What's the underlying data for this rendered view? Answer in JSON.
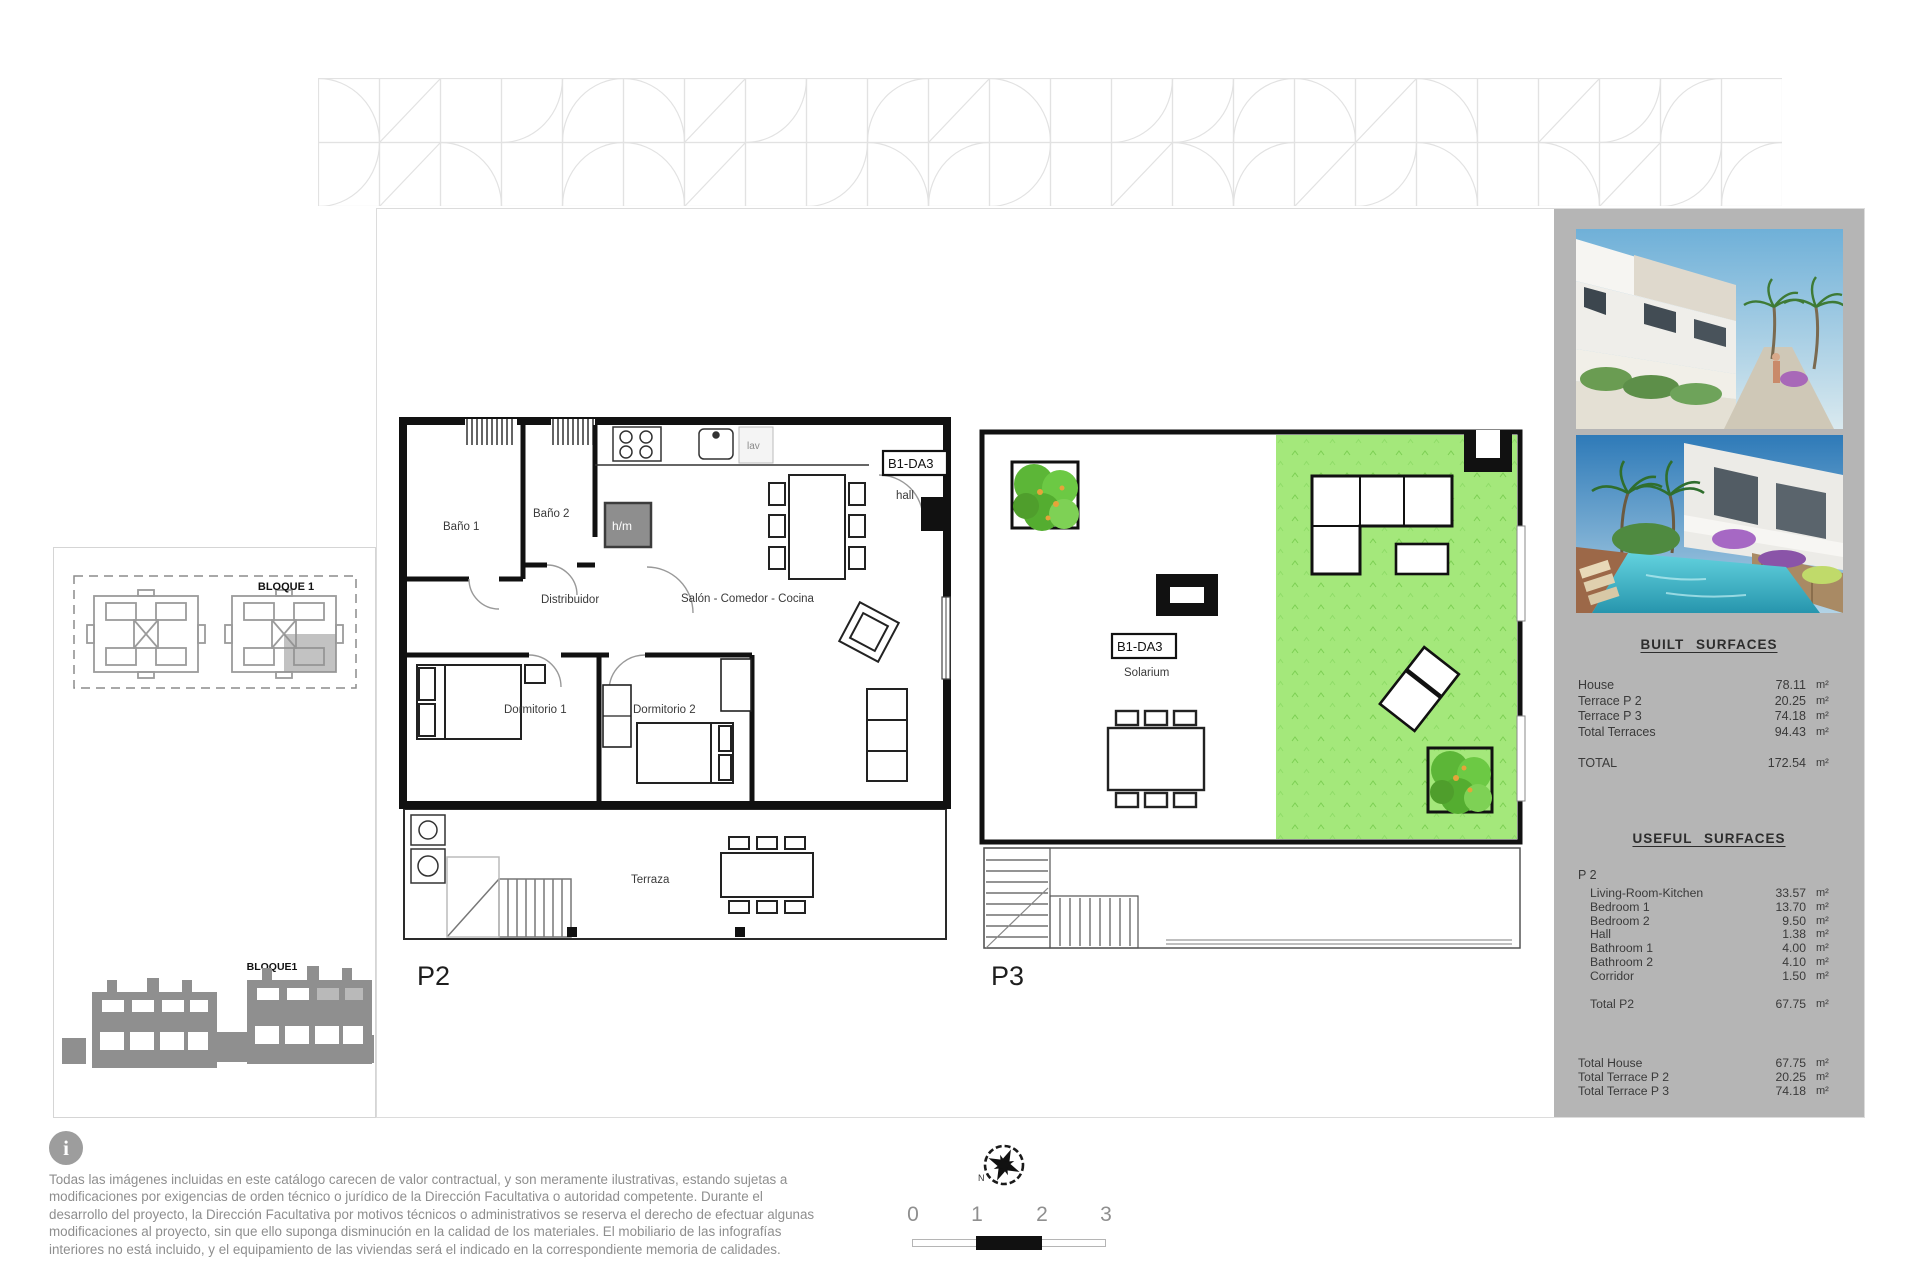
{
  "floorplans": {
    "p2": {
      "label": "P2",
      "unit_code": "B1-DA3",
      "hall": "hall",
      "rooms": {
        "bano1": "Baño 1",
        "bano2": "Baño 2",
        "distribuidor": "Distribuidor",
        "salon": "Salón - Comedor - Cocina",
        "dorm1": "Dormitorio 1",
        "dorm2": "Dormitorio 2",
        "terraza": "Terraza",
        "hm": "h/m",
        "lav": "lav"
      }
    },
    "p3": {
      "label": "P3",
      "unit_code": "B1-DA3",
      "solarium": "Solarium"
    }
  },
  "siteplan": {
    "bloque_top": "BLOQUE 1",
    "bloque_bottom": "BLOQUE1"
  },
  "surfaces": {
    "built": {
      "title": "BUILT SURFACES",
      "rows": [
        {
          "label": "House",
          "value": "78.11",
          "unit": "m²"
        },
        {
          "label": "Terrace P 2",
          "value": "20.25",
          "unit": "m²"
        },
        {
          "label": "Terrace P 3",
          "value": "74.18",
          "unit": "m²"
        },
        {
          "label": "Total Terraces",
          "value": "94.43",
          "unit": "m²"
        }
      ],
      "total": {
        "label": "TOTAL",
        "value": "172.54",
        "unit": "m²"
      }
    },
    "useful": {
      "title": "USEFUL SURFACES",
      "floor_label": "P 2",
      "rows": [
        {
          "label": "Living-Room-Kitchen",
          "value": "33.57",
          "unit": "m²"
        },
        {
          "label": "Bedroom 1",
          "value": "13.70",
          "unit": "m²"
        },
        {
          "label": "Bedroom 2",
          "value": "9.50",
          "unit": "m²"
        },
        {
          "label": "Hall",
          "value": "1.38",
          "unit": "m²"
        },
        {
          "label": "Bathroom 1",
          "value": "4.00",
          "unit": "m²"
        },
        {
          "label": "Bathroom 2",
          "value": "4.10",
          "unit": "m²"
        },
        {
          "label": "Corridor",
          "value": "1.50",
          "unit": "m²"
        }
      ],
      "subtotal": {
        "label": "Total P2",
        "value": "67.75",
        "unit": "m²"
      },
      "totals": [
        {
          "label": "Total House",
          "value": "67.75",
          "unit": "m²"
        },
        {
          "label": "Total Terrace P 2",
          "value": "20.25",
          "unit": "m²"
        },
        {
          "label": "Total Terrace P 3",
          "value": "74.18",
          "unit": "m²"
        }
      ]
    }
  },
  "footer": {
    "disclaimer": "Todas las imágenes incluidas en este catálogo carecen de valor contractual, y son meramente ilustrativas, estando sujetas a modificaciones por exigencias de orden técnico o jurídico de la Dirección Facultativa o autoridad competente. Durante el desarrollo del proyecto, la Dirección Facultativa por motivos técnicos o administrativos se reserva el derecho de efectuar algunas modificaciones al proyecto, sin que ello suponga disminución en la calidad de los materiales. El mobiliario de las infografías interiores no está incluido, y el equipamiento de las viviendas será el indicado en la correspondiente memoria de calidades.",
    "info_glyph": "i",
    "compass_north": "N",
    "scale_ticks": [
      "0",
      "1",
      "2",
      "3"
    ]
  }
}
